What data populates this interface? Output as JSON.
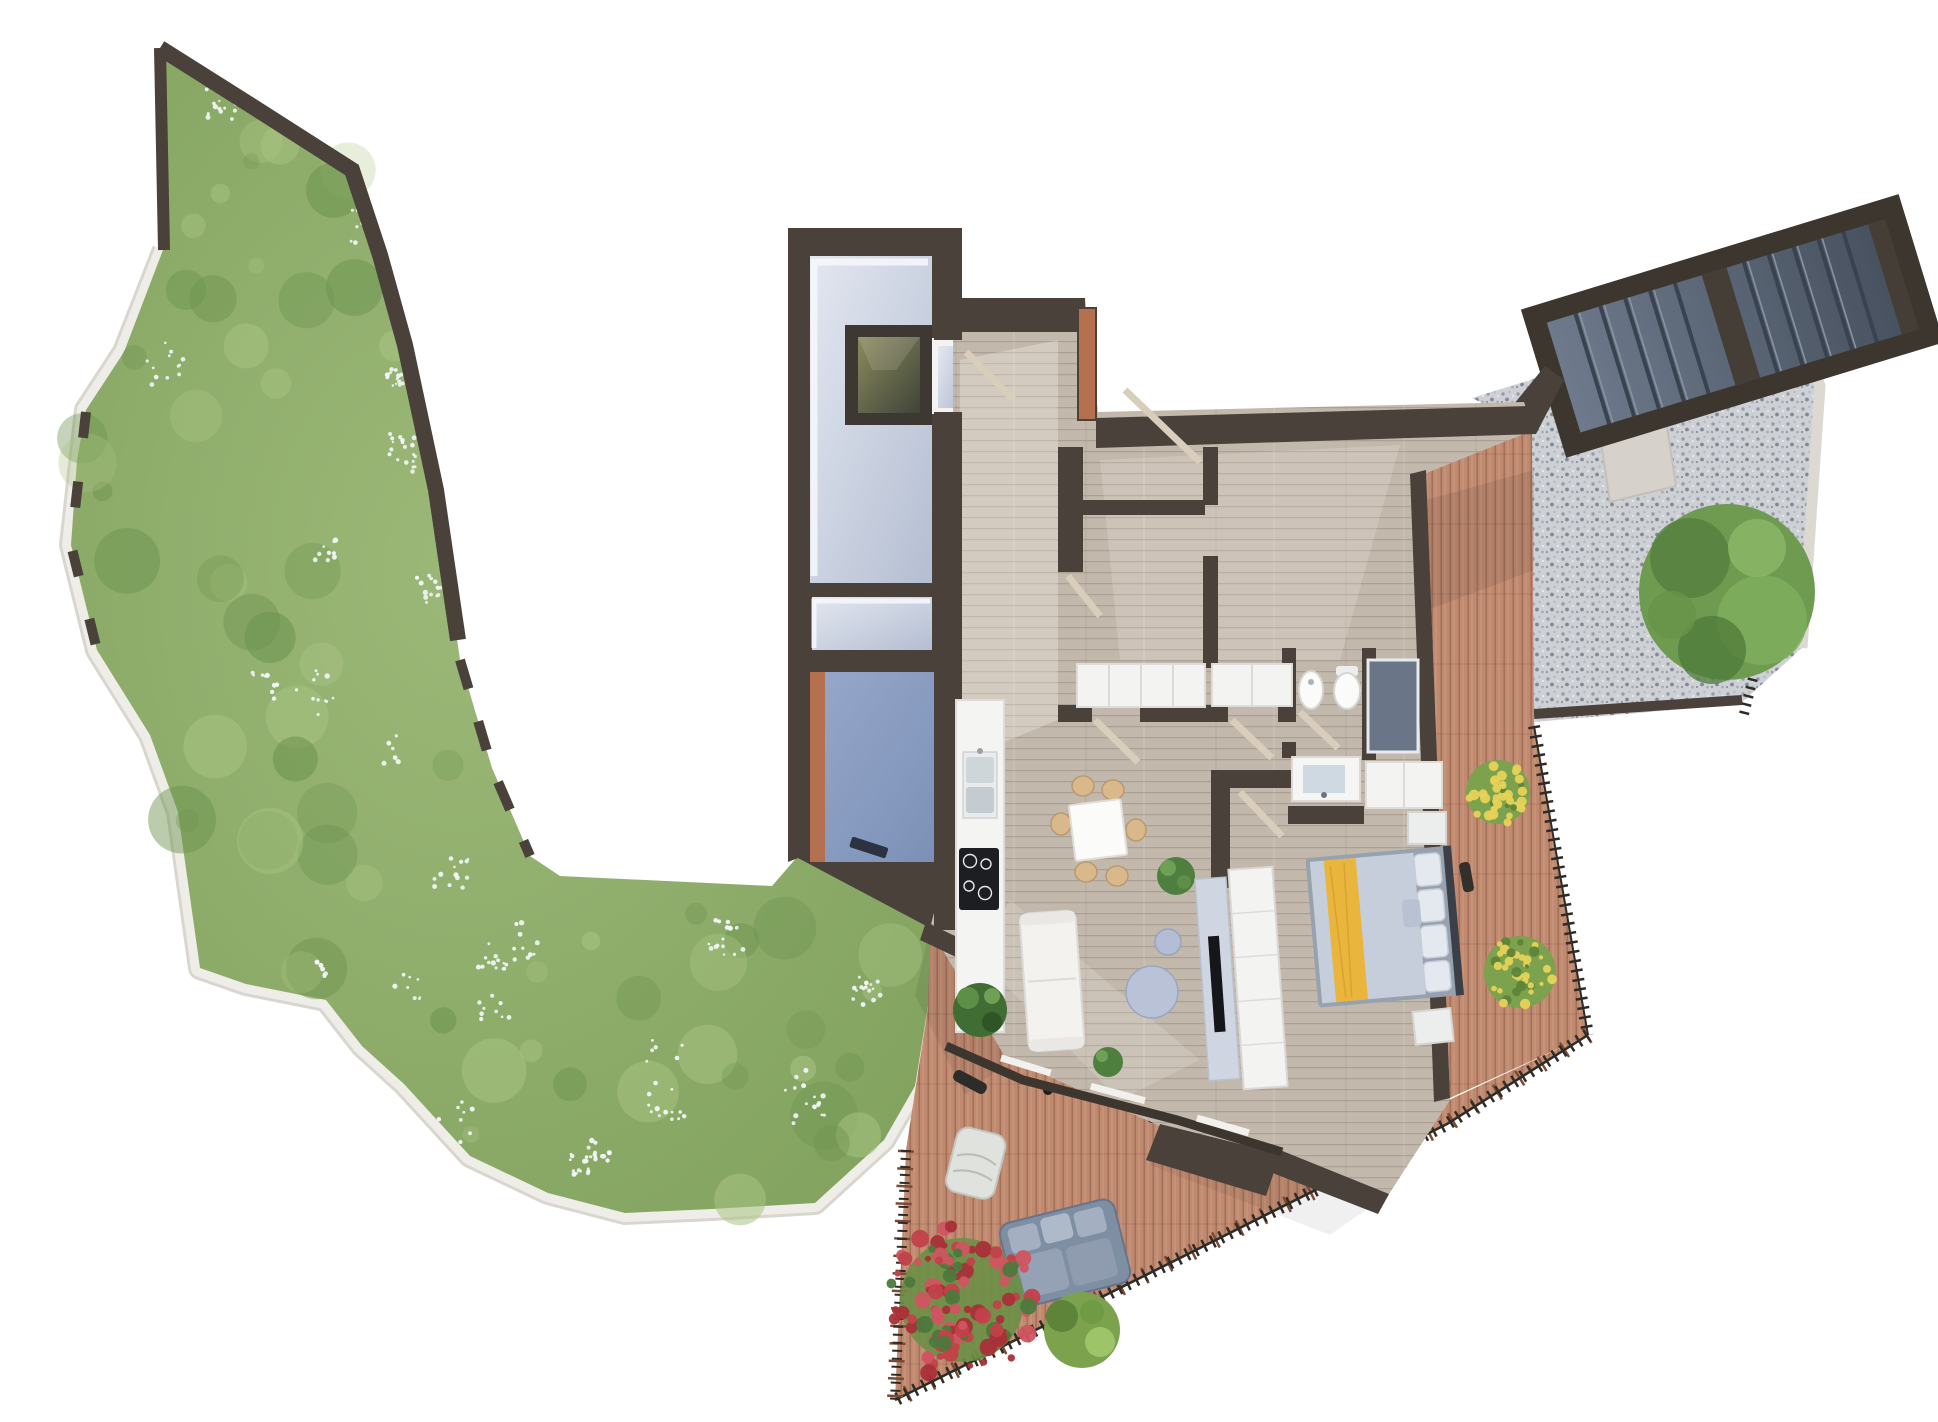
{
  "scene": {
    "title": "Top-down 3D architectural floor plan render: one-bedroom apartment with wrap-around wooden terrace, gravel patio with outdoor staircase, and a large curved flower garden",
    "type": "3d-floor-plan-top-view",
    "background": "#ffffff"
  },
  "palette": {
    "wall_dark": "#49413a",
    "wall_darker": "#3d362f",
    "terracotta": "#b5714f",
    "wood_floor": "#c2b8ac",
    "deck_wood": "#c08a70",
    "concrete_light": "#ccd4e2",
    "cellar_blue": "#8da0c4",
    "gravel": "#cdd0d4",
    "slate_stairs": "#5f6b7c",
    "garden_green": "#8fae6d",
    "garden_green_dark": "#6d934f",
    "garden_green_light": "#a9c483",
    "flower_white": "#f2f6f8",
    "flower_red": "#c2414a",
    "flower_yellow": "#e7d258",
    "tree_green": "#6e9b50",
    "path_white": "#efede8",
    "railing_black": "#2f2b26",
    "railing_wood": "#7a4b33",
    "sofa_white": "#f3f2ef",
    "outdoor_sofa_gray": "#7e8ea3",
    "coffee_table_blue": "#b3bdd3",
    "bed_blanket_yellow": "#e9b53d",
    "bed_duvet": "#c7cedb",
    "cabinet_white": "#f3f3f1",
    "cooktop_black": "#1c1e22",
    "chair_wood_tan": "#d9b98c"
  },
  "areas": {
    "garden": {
      "label": "Curved garden with lawn, shrubs and white flowers, bordered by a dark wall and a white stone path"
    },
    "entry_block": {
      "label": "Entry / service block with concrete stairwell, storage room and blue-floored cellar",
      "rooms": [
        {
          "label": "Concrete entry stairwell with roof hatch / skylight opening"
        },
        {
          "label": "Small concrete storage room"
        },
        {
          "label": "Cellar room with blue concrete floor and terracotta wall"
        }
      ]
    },
    "apartment": {
      "label": "Apartment interior with light wooden plank flooring",
      "rooms": [
        {
          "label": "Entry hallway"
        },
        {
          "label": "Corridor to bedrooms and bathroom"
        },
        {
          "label": "Bedroom 1 with built-in closets"
        },
        {
          "label": "Bedroom 2 with built-in closets"
        },
        {
          "label": "Bathroom with bidet, toilet, vanity sink and shower"
        },
        {
          "label": "Open kitchen with sink and induction cooktop"
        },
        {
          "label": "Dining area with square table and six chairs"
        },
        {
          "label": "Living area with white sofa, round coffee tables, TV sideboard and wardrobe"
        },
        {
          "label": "Master bedroom with double bed with yellow runner"
        }
      ]
    },
    "terraces": {
      "right_deck": {
        "label": "East wooden deck terrace with yellow flower planters"
      },
      "lower_deck": {
        "label": "Triangular south wooden deck terrace with outdoor lounge furniture and railing"
      },
      "gravel_terrace": {
        "label": "Gravel patio with ornamental tree"
      },
      "staircase": {
        "label": "External slate staircase, two flights with intermediate landing"
      }
    }
  },
  "furniture": {
    "kitchen": {
      "counter": "white counter run",
      "sink_basins": 2,
      "cooktop_burners": 4
    },
    "dining": {
      "table": "white square table",
      "chairs": 6,
      "potted_plants": 2
    },
    "living": {
      "sofa": "white three-seat sofa",
      "coffee_tables": 2,
      "tv_sideboard": 1,
      "tv": 1,
      "wardrobe": 1,
      "potted_plants": 2
    },
    "bedroom": {
      "bed": "double bed, gray duvet, yellow runner, four pillows",
      "nightstands": 2,
      "closet": 1
    },
    "bathroom": {
      "bidet": 1,
      "toilet": 1,
      "vanity_sink": 1,
      "shower": 1
    },
    "closets_rows": 2,
    "outdoor": {
      "outdoor_sofa": 1,
      "lounge_chair": 1,
      "red_flower_bush": 1,
      "green_bush": 1,
      "yellow_flower_bushes": 2,
      "tree": 1,
      "stairs_flights": 2,
      "steps_per_flight": 5
    }
  }
}
